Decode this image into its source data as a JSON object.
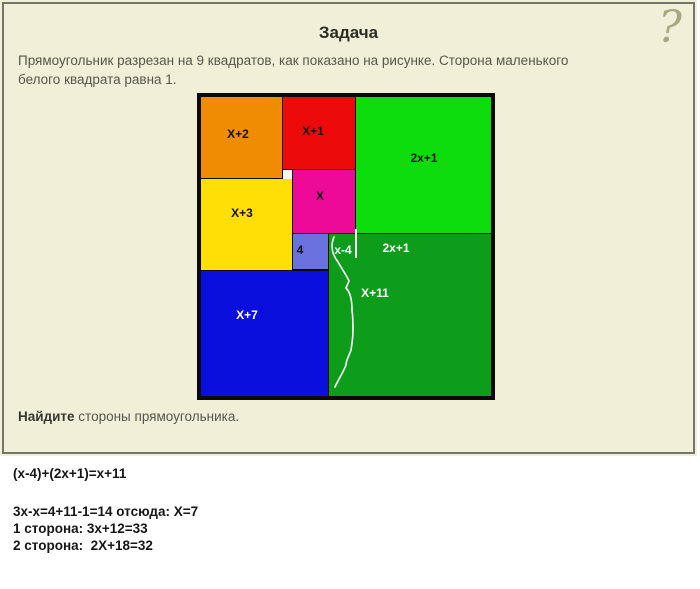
{
  "panel": {
    "question_mark": "?",
    "background": "#f2efd8",
    "border_color": "#75756a"
  },
  "title": "Задача",
  "problem": {
    "line1": "Прямоугольник разрезан на 9 квадратов, как показано на рисунке. Сторона маленького",
    "line2": "белого квадрата равна 1."
  },
  "figure": {
    "squares": [
      {
        "id": "orange",
        "label": "X+2",
        "color": "#f08c04"
      },
      {
        "id": "red",
        "label": "X+1",
        "color": "#ec0a0a"
      },
      {
        "id": "green-light",
        "label": "2x+1",
        "color": "#0ddd0d"
      },
      {
        "id": "white-unit",
        "label": "",
        "color": "#f7f7ef"
      },
      {
        "id": "magenta",
        "label": "X",
        "color": "#ee0a99"
      },
      {
        "id": "yellow",
        "label": "X+3",
        "color": "#ffdf06"
      },
      {
        "id": "violet",
        "label": "4",
        "color": "#6a72e0"
      },
      {
        "id": "blue",
        "label": "X+7",
        "color": "#0a0fdd"
      },
      {
        "id": "green-dark",
        "label": "2x+1",
        "color": "#0e9c1b"
      }
    ],
    "annotations": {
      "x_minus_4": "x-4",
      "green_strip": "2x+1",
      "brace_label": "X+11"
    }
  },
  "find": {
    "bold": "Найдите",
    "rest": " стороны прямоугольника."
  },
  "solution": {
    "line1": "(x-4)+(2x+1)=x+11",
    "line2": "3x-x=4+11-1=14 отсюда: X=7",
    "line3": "1 сторона: 3x+12=33",
    "line4": "2 сторона:  2X+18=32"
  }
}
